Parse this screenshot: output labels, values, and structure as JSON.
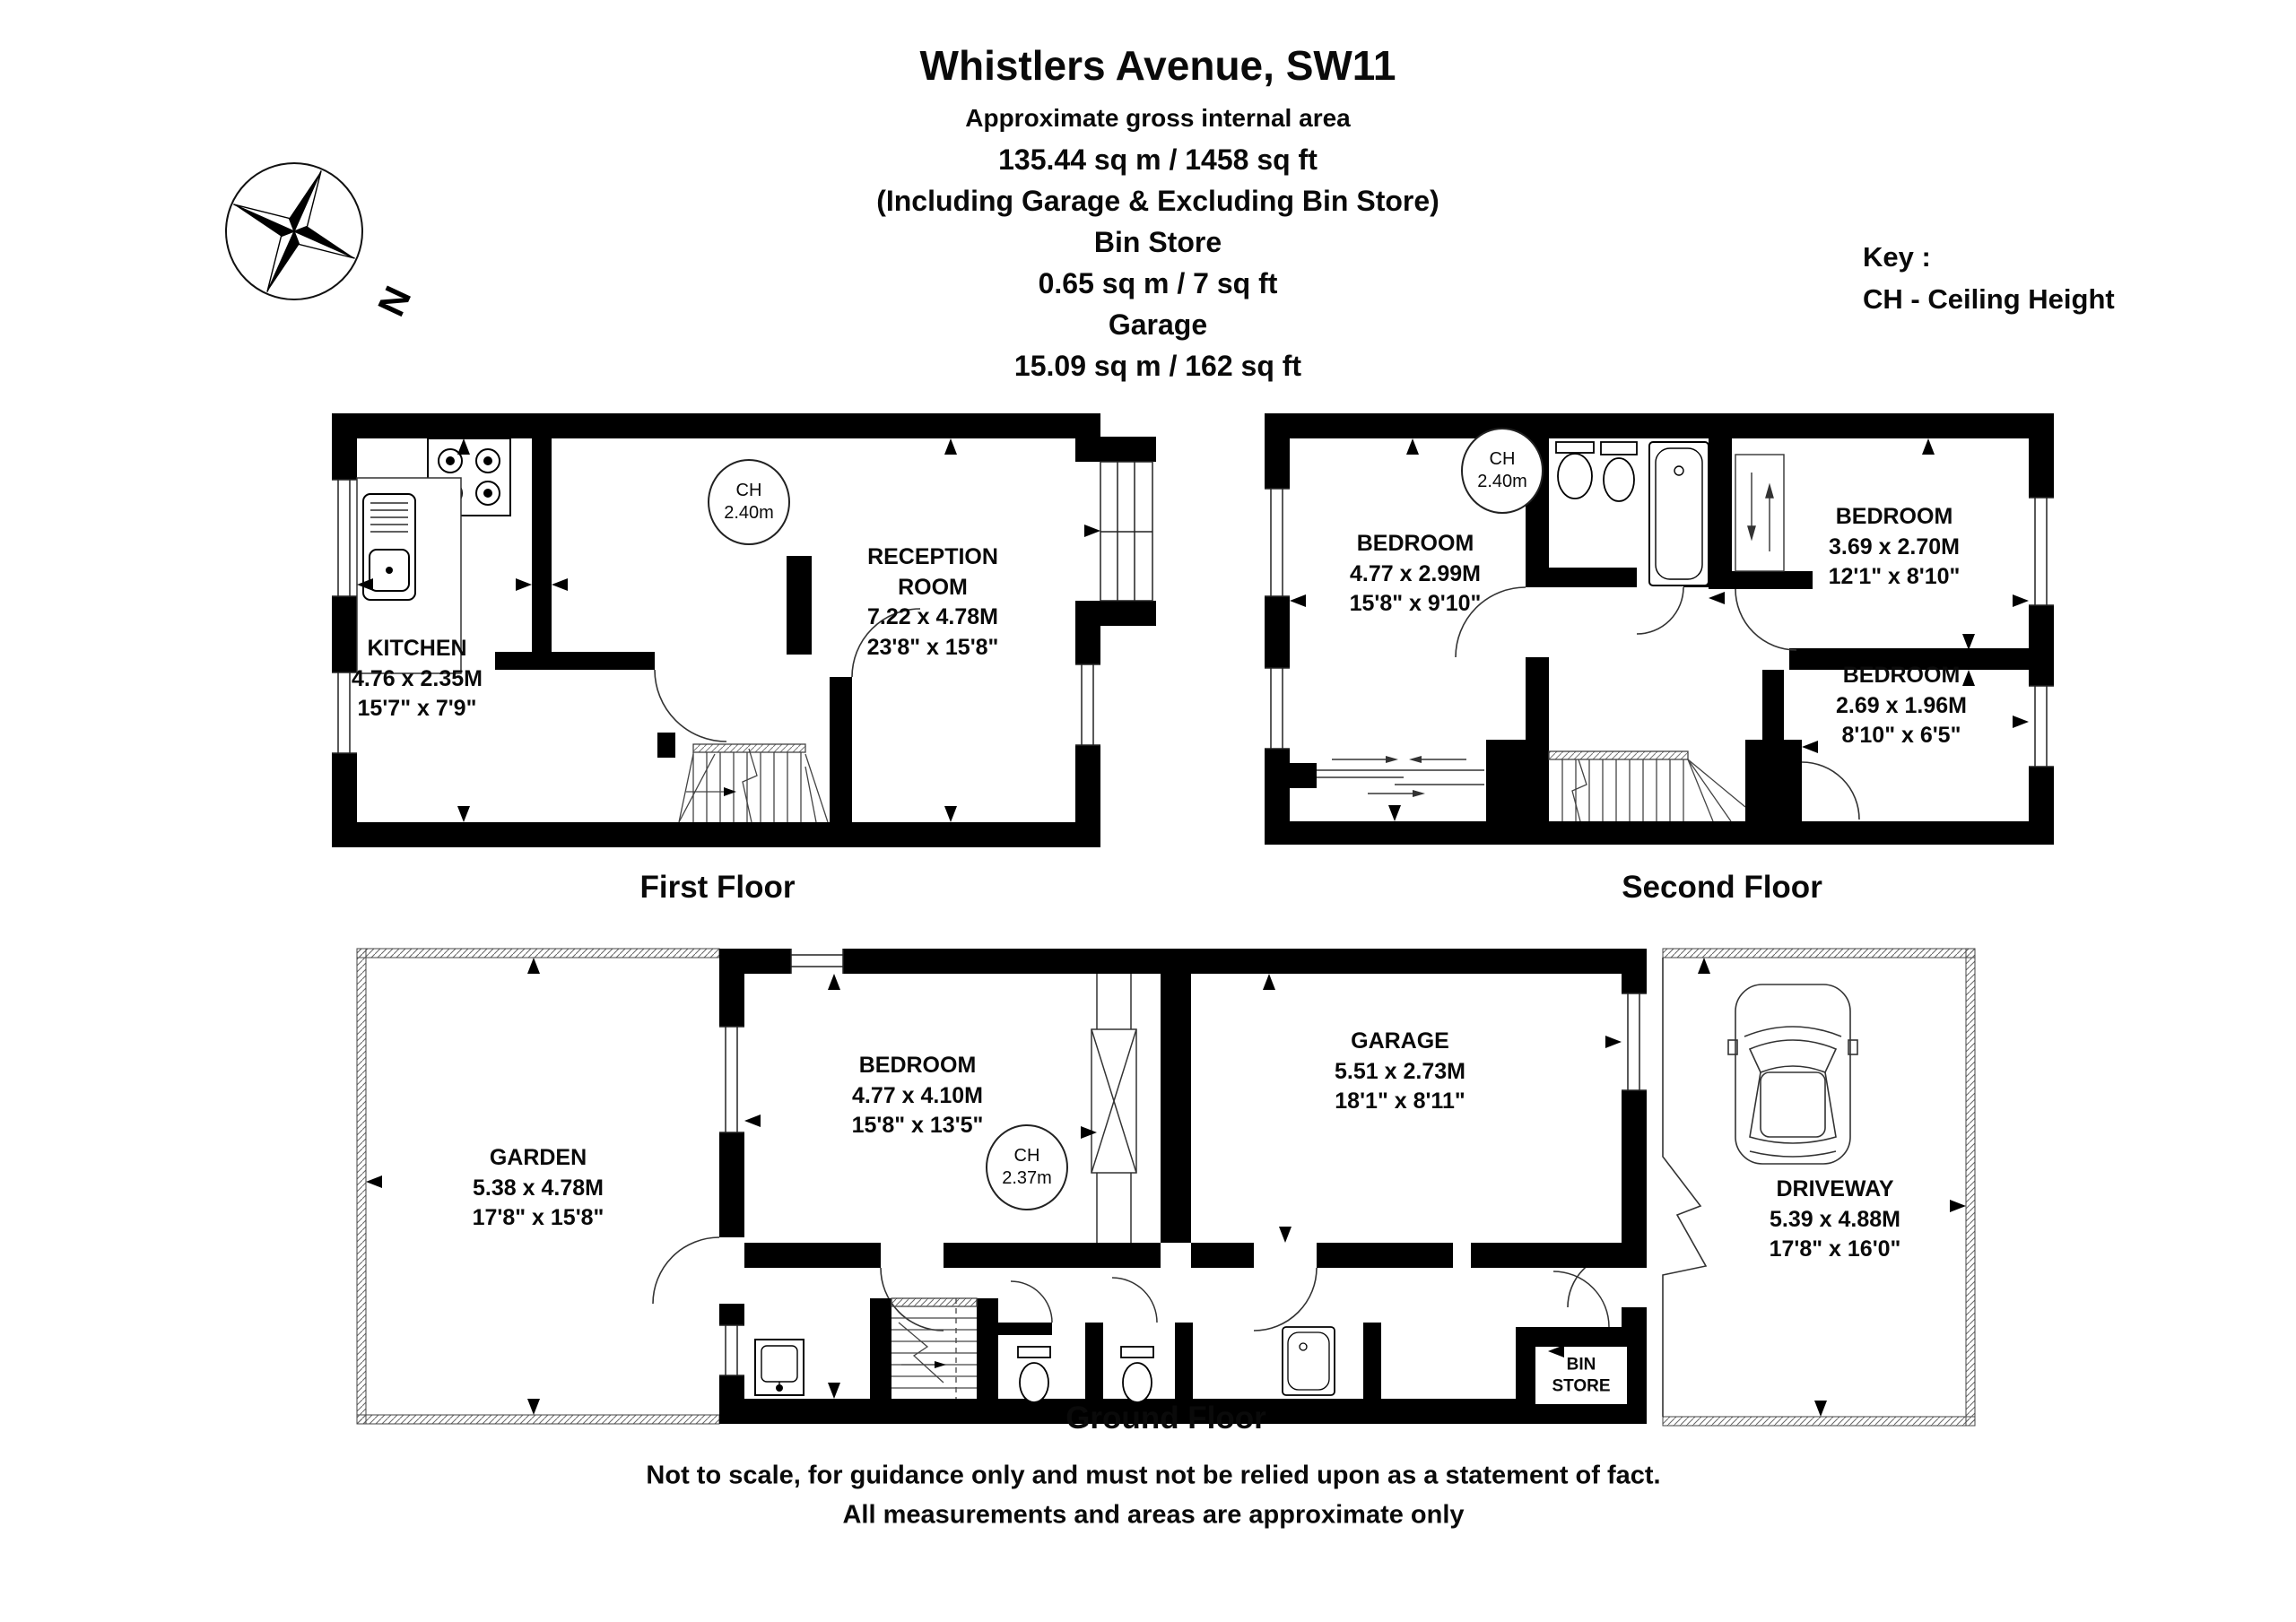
{
  "header": {
    "title": "Whistlers Avenue, SW11",
    "subtitle": "Approximate gross internal area",
    "total_area": "135.44 sq m / 1458 sq ft",
    "total_note": "(Including Garage & Excluding Bin Store)",
    "bin_store_name": "Bin Store",
    "bin_store_area": "0.65 sq m / 7 sq ft",
    "garage_name": "Garage",
    "garage_area": "15.09 sq m / 162 sq ft"
  },
  "key": {
    "title": "Key :",
    "ch": "CH - Ceiling Height"
  },
  "compass": {
    "north": "N"
  },
  "first_floor": {
    "label": "First Floor",
    "ch": {
      "line1": "CH",
      "line2": "2.40m"
    },
    "kitchen": {
      "name": "KITCHEN",
      "metric": "4.76 x 2.35M",
      "imperial": "15'7\" x 7'9\""
    },
    "reception": {
      "name1": "RECEPTION",
      "name2": "ROOM",
      "metric": "7.22 x 4.78M",
      "imperial": "23'8\" x 15'8\""
    }
  },
  "second_floor": {
    "label": "Second Floor",
    "ch": {
      "line1": "CH",
      "line2": "2.40m"
    },
    "bedroom1": {
      "name": "BEDROOM",
      "metric": "4.77 x 2.99M",
      "imperial": "15'8\" x 9'10\""
    },
    "bedroom2": {
      "name": "BEDROOM",
      "metric": "3.69 x 2.70M",
      "imperial": "12'1\" x 8'10\""
    },
    "bedroom3": {
      "name": "BEDROOM",
      "metric": "2.69 x 1.96M",
      "imperial": "8'10\" x 6'5\""
    }
  },
  "ground_floor": {
    "label": "Ground Floor",
    "ch": {
      "line1": "CH",
      "line2": "2.37m"
    },
    "garden": {
      "name": "GARDEN",
      "metric": "5.38 x 4.78M",
      "imperial": "17'8\" x 15'8\""
    },
    "bedroom": {
      "name": "BEDROOM",
      "metric": "4.77 x 4.10M",
      "imperial": "15'8\" x 13'5\""
    },
    "garage": {
      "name": "GARAGE",
      "metric": "5.51 x 2.73M",
      "imperial": "18'1\" x 8'11\""
    },
    "driveway": {
      "name": "DRIVEWAY",
      "metric": "5.39 x 4.88M",
      "imperial": "17'8\" x 16'0\""
    },
    "bin_store": {
      "line1": "BIN",
      "line2": "STORE"
    }
  },
  "footer": {
    "line1": "Not to scale, for guidance only and must not be relied upon as a statement of fact.",
    "line2": "All measurements and areas are approximate only"
  }
}
